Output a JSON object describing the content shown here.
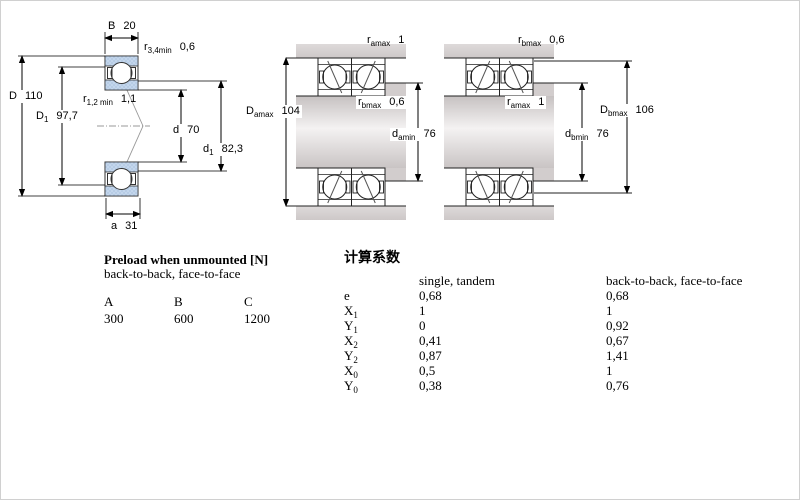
{
  "drawing": {
    "description": "Angular contact ball bearing dimension drawings: single bearing cross-section, back-to-back mounted pair, face-to-face mounted pair",
    "colors": {
      "bearing_ring_fill": "#c3d6ec",
      "bearing_ring_dot": "#9ab5d6",
      "steel_gray": "#d2cdcd",
      "line_color": "#222222"
    },
    "dim_labels": {
      "b": {
        "main": "B",
        "sub": "",
        "value": "20"
      },
      "r34": {
        "main": "r",
        "sub": "3,4min",
        "value": "0,6"
      },
      "D": {
        "main": "D",
        "sub": "",
        "value": "110"
      },
      "D1": {
        "main": "D",
        "sub": "1",
        "value": "97,7"
      },
      "r12": {
        "main": "r",
        "sub": "1,2 min",
        "value": "1,1"
      },
      "d": {
        "main": "d",
        "sub": "",
        "value": "70"
      },
      "d1": {
        "main": "d",
        "sub": "1",
        "value": "82,3"
      },
      "a": {
        "main": "a",
        "sub": "",
        "value": "31"
      },
      "m_ramax": {
        "main": "r",
        "sub": "amax",
        "value": "1"
      },
      "m_Damax": {
        "main": "D",
        "sub": "amax",
        "value": "104"
      },
      "m_rbmax": {
        "main": "r",
        "sub": "bmax",
        "value": "0,6"
      },
      "m_damin": {
        "main": "d",
        "sub": "amin",
        "value": "76"
      },
      "f_rbmax": {
        "main": "r",
        "sub": "bmax",
        "value": "0,6"
      },
      "f_ramax": {
        "main": "r",
        "sub": "amax",
        "value": "1"
      },
      "f_Dbmax": {
        "main": "D",
        "sub": "bmax",
        "value": "106"
      },
      "f_dbmin": {
        "main": "d",
        "sub": "bmin",
        "value": "76"
      }
    }
  },
  "preload": {
    "title": "Preload when unmounted [N]",
    "subtitle": "back-to-back, face-to-face",
    "columns": [
      "A",
      "B",
      "C"
    ],
    "values": [
      "300",
      "600",
      "1200"
    ]
  },
  "factors": {
    "title": "计算系数",
    "col1_header": "single, tandem",
    "col2_header": "back-to-back, face-to-face",
    "rows": [
      {
        "sym": "e",
        "sub": "",
        "single_tandem": "0,68",
        "back_to_back": "0,68"
      },
      {
        "sym": "X",
        "sub": "1",
        "single_tandem": "1",
        "back_to_back": "1"
      },
      {
        "sym": "Y",
        "sub": "1",
        "single_tandem": "0",
        "back_to_back": "0,92"
      },
      {
        "sym": "X",
        "sub": "2",
        "single_tandem": "0,41",
        "back_to_back": "0,67"
      },
      {
        "sym": "Y",
        "sub": "2",
        "single_tandem": "0,87",
        "back_to_back": "1,41"
      },
      {
        "sym": "X",
        "sub": "0",
        "single_tandem": "0,5",
        "back_to_back": "1"
      },
      {
        "sym": "Y",
        "sub": "0",
        "single_tandem": "0,38",
        "back_to_back": "0,76"
      }
    ]
  }
}
